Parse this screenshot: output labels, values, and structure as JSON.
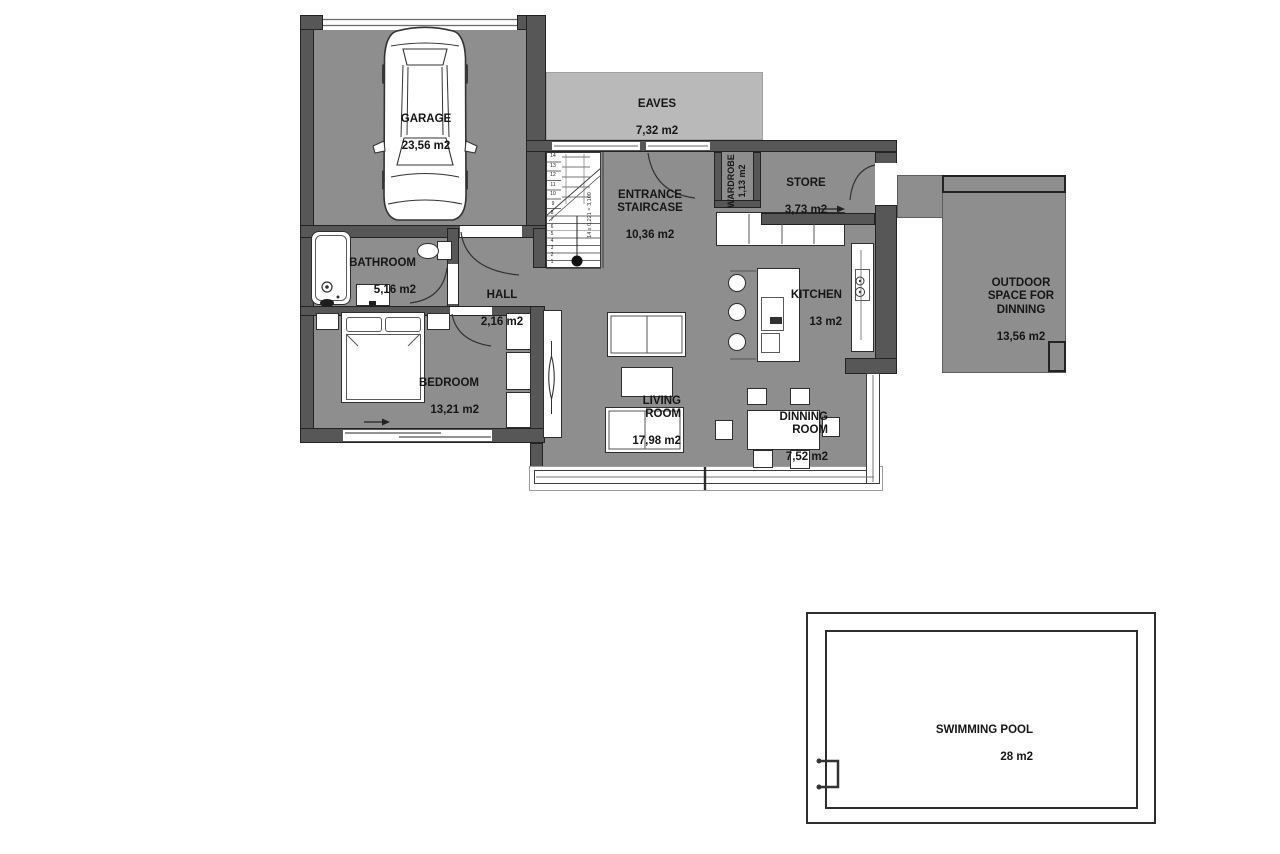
{
  "colors": {
    "room": "#8e8e8e",
    "wall": "#575757",
    "eaves": "#b9b9b9",
    "outline": "#232323"
  },
  "rooms": {
    "garage": {
      "name": "GARAGE",
      "area": "23,56 m2"
    },
    "eaves": {
      "name": "EAVES",
      "area": "7,32 m2"
    },
    "entrance": {
      "name": "ENTRANCE\nSTAIRCASE",
      "area": "10,36 m2"
    },
    "wardrobe": {
      "name": "WARDROBE",
      "area": "1,13 m2"
    },
    "store": {
      "name": "STORE",
      "area": "3,73 m2"
    },
    "outdoor": {
      "name": "OUTDOOR\nSPACE FOR\nDINNING",
      "area": "13,56 m2"
    },
    "bathroom": {
      "name": "BATHROOM",
      "area": "5,16 m2"
    },
    "hall": {
      "name": "HALL",
      "area": "2,16 m2"
    },
    "kitchen": {
      "name": "KITCHEN",
      "area": "13 m2"
    },
    "bedroom": {
      "name": "BEDROOM",
      "area": "13,21 m2"
    },
    "living": {
      "name": "LIVING\nROOM",
      "area": "17,98 m2"
    },
    "dining": {
      "name": "DINNING\nROOM",
      "area": "7,52 m2"
    },
    "pool": {
      "name": "SWIMMING POOL",
      "area": "28 m2"
    }
  },
  "stairs": {
    "note": "14 x 0,221 = 3,100",
    "upper_steps": [
      "14",
      "13",
      "12",
      "11",
      "10",
      "9"
    ],
    "lower_steps": [
      "8",
      "7",
      "6",
      "5",
      "4",
      "3",
      "2",
      "1"
    ]
  }
}
